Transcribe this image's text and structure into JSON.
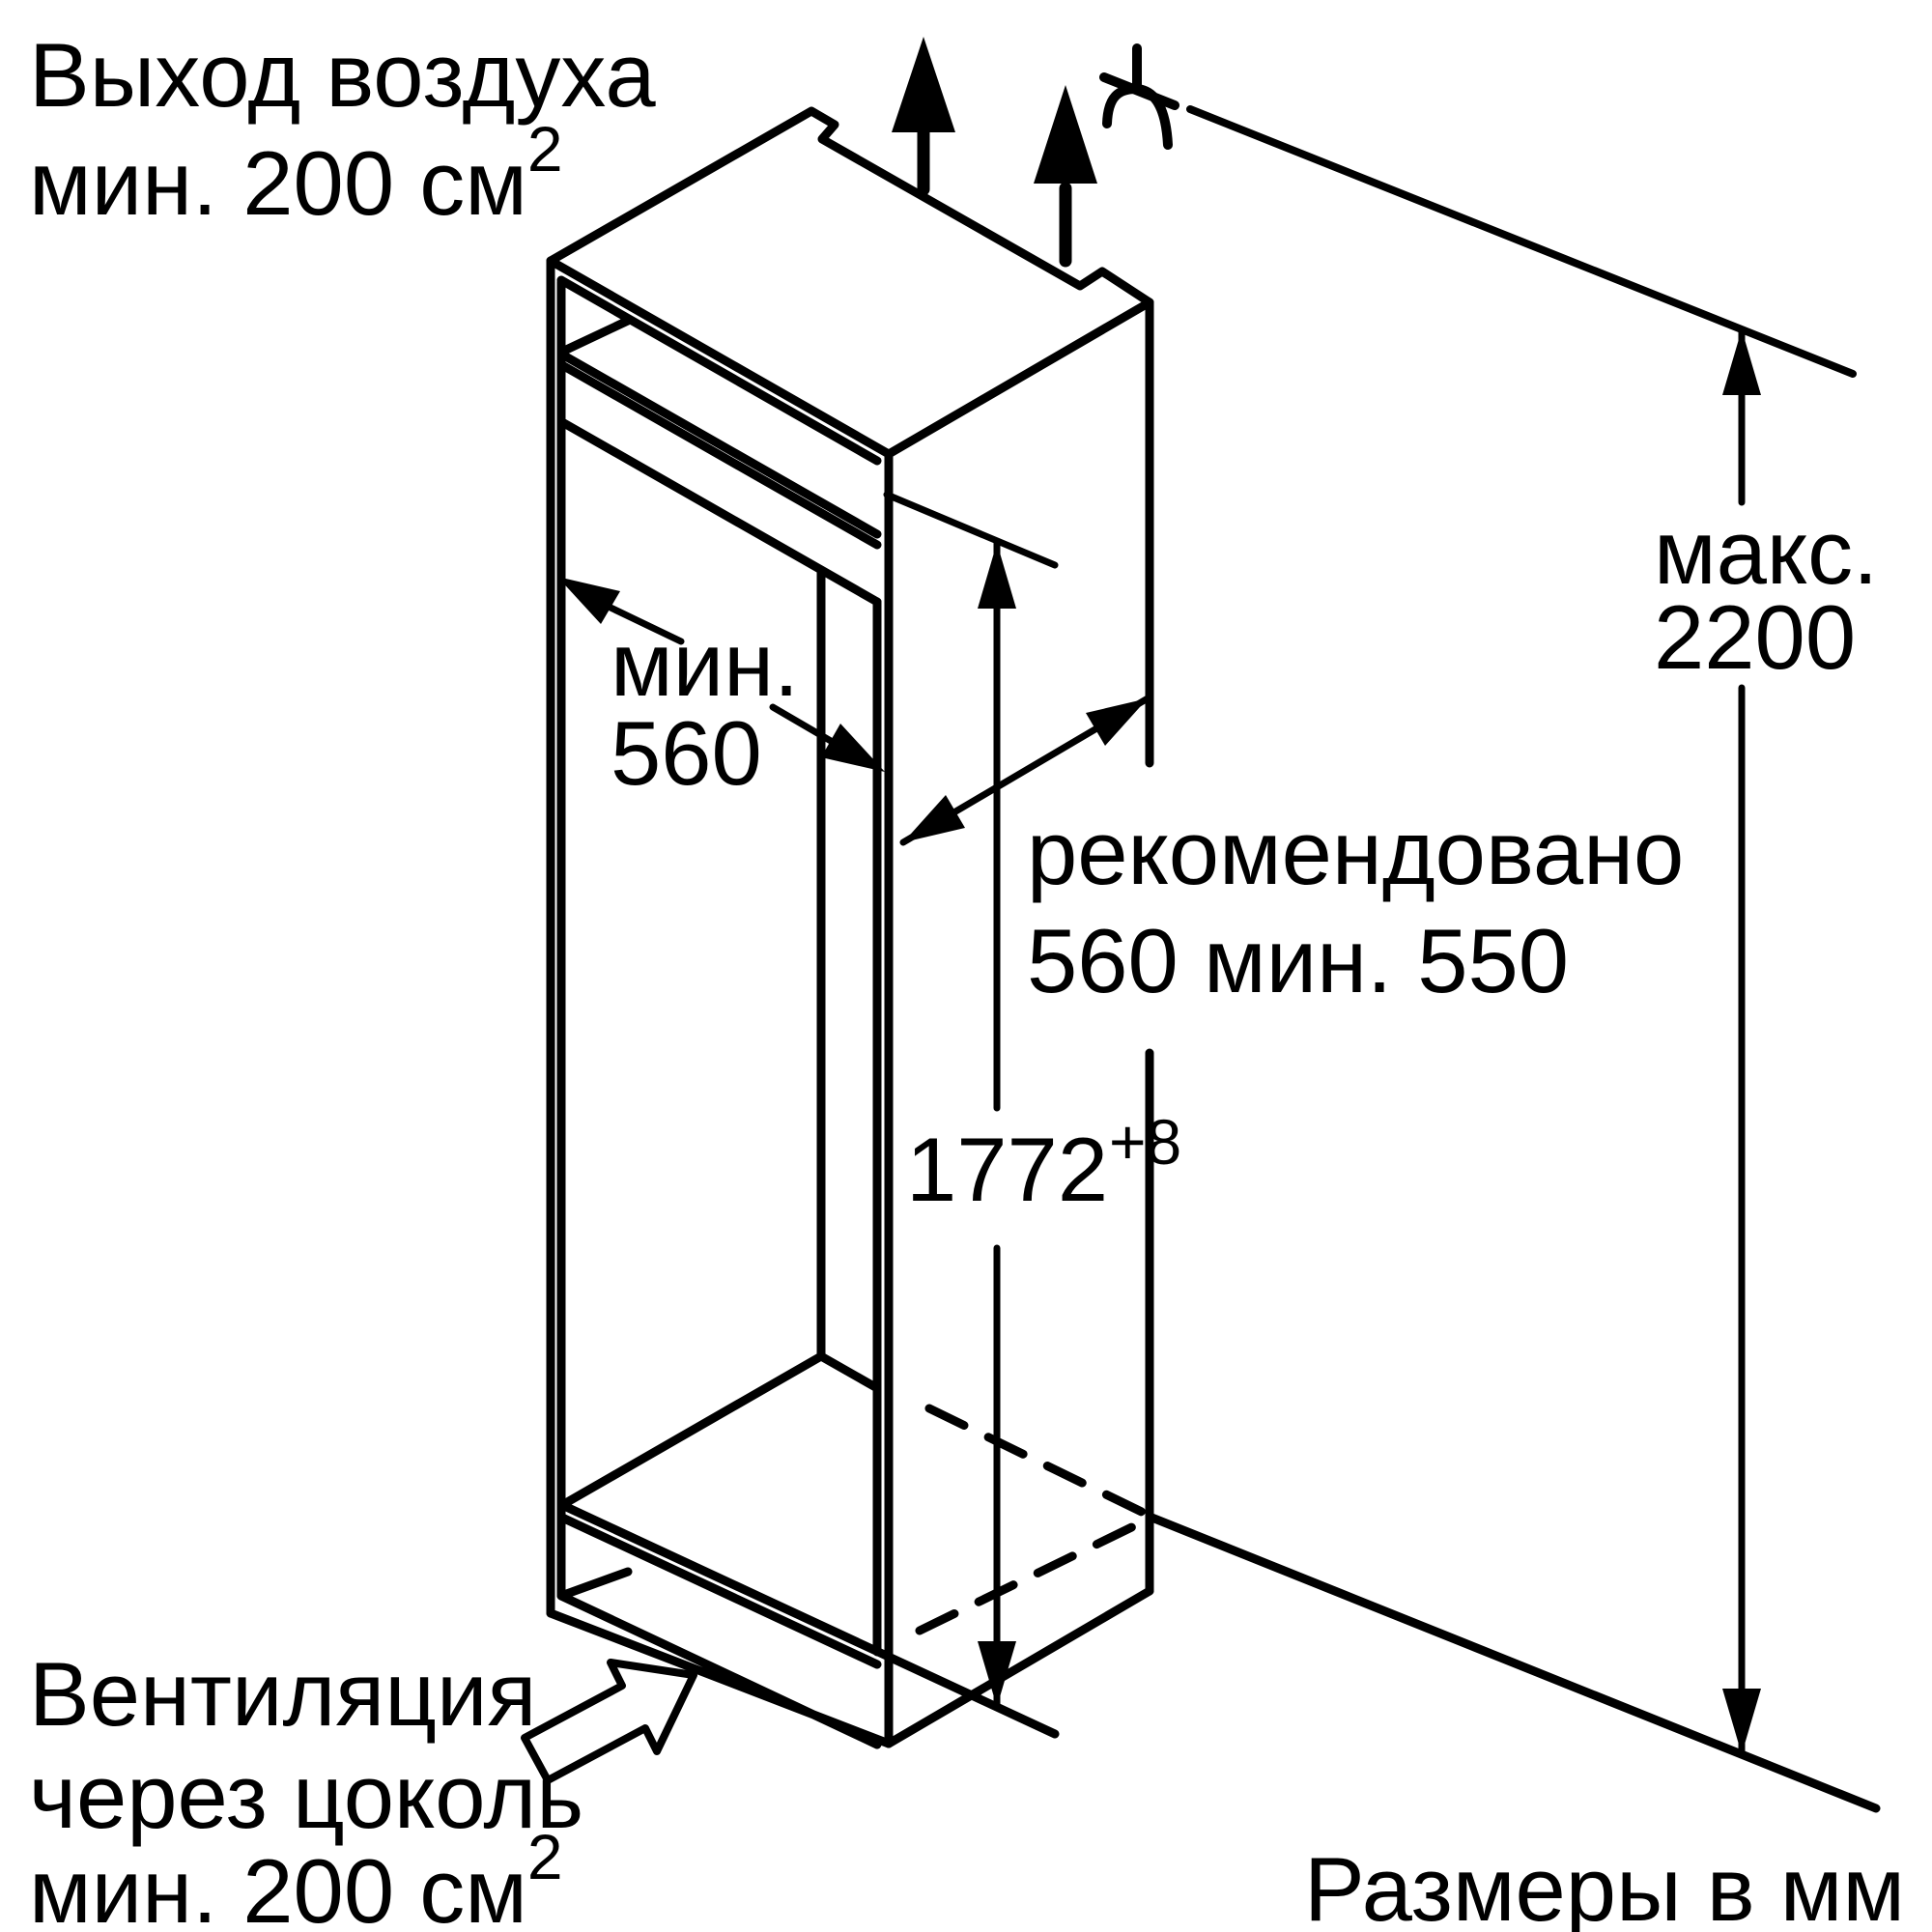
{
  "diagram": {
    "background": "#ffffff",
    "line_color": "#000000",
    "labels": {
      "air_outlet_line1": "Выход воздуха",
      "air_outlet_line2": "мин. 200 см",
      "air_outlet_sup": "2",
      "plinth_line1": "Вентиляция",
      "plinth_line2": "через цоколь",
      "plinth_line3": "мин. 200 см",
      "plinth_sup": "2",
      "units": "Размеры в мм"
    },
    "dimensions": {
      "width_line1": "мин.",
      "width_line2": "560",
      "depth_line1": "рекомендовано",
      "depth_line2": "560 мин. 550",
      "height_value": "1772",
      "height_tolerance": "+8",
      "max_line1": "макс.",
      "max_line2": "2200"
    },
    "icons": {
      "air_flow": "solid-up-arrow",
      "power_cord": "cord-curve",
      "plinth_flow": "hollow-up-right-arrow"
    }
  }
}
